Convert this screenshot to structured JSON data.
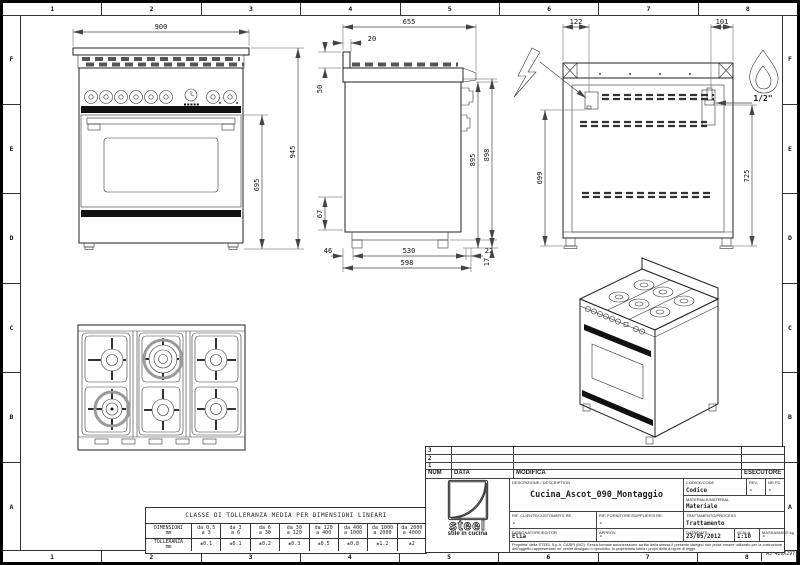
{
  "sheet": {
    "columns": [
      "1",
      "2",
      "3",
      "4",
      "5",
      "6",
      "7",
      "8"
    ],
    "rows": [
      "F",
      "E",
      "D",
      "C",
      "B",
      "A"
    ],
    "format_label": "A3 420X297"
  },
  "drawing": {
    "front": {
      "width": "900",
      "door_height": "695",
      "total_height": "945"
    },
    "side": {
      "total_depth": "655",
      "backsplash_offset": "20",
      "backsplash_height": "50",
      "worktop_height": "895",
      "overall_height": "898",
      "plinth_height": "67",
      "rear_foot_inset": "46",
      "foot_span": "530",
      "front_foot_inset": "22",
      "base_depth": "598",
      "foot_height": "17"
    },
    "back": {
      "electric_offset": "122",
      "gas_offset": "101",
      "electric_height": "699",
      "gas_height": "725",
      "gas_thread": "1/2\""
    }
  },
  "tolerance_table": {
    "title": "CLASSE DI TOLLERANZA MEDIA PER DIMENSIONI LINEARI",
    "dim_header": "DIMENSIONI",
    "dim_unit": "mm",
    "tol_header": "TOLLERANZA",
    "tol_unit": "mm",
    "ranges_from": [
      "da 0.5",
      "da 3",
      "da 6",
      "da 30",
      "da 120",
      "da 400",
      "da 1000",
      "da 2000"
    ],
    "ranges_to": [
      "a 3",
      "a 6",
      "a 30",
      "a 120",
      "a 400",
      "a 1000",
      "a 2000",
      "a 4000"
    ],
    "tolerances": [
      "±0.1",
      "±0.1",
      "±0.2",
      "±0.3",
      "±0.5",
      "±0.8",
      "±1.2",
      "±2"
    ]
  },
  "title_block": {
    "rev_rows": [
      "3",
      "2",
      "1"
    ],
    "num_header": "NUM",
    "data_header": "DATA",
    "modifica_header": "MODIFICA",
    "esecutore_header": "ESECUTORE",
    "description_label": "DESCRIZIONE / DESCRIPTION",
    "description": "Cucina_Ascot_090_Montaggio",
    "code_label": "CODICE/CODE",
    "code": "Codice",
    "rev_label": "REV.",
    "rev": "-",
    "pieces_label": "NR.PZ.",
    "pieces": "-",
    "material_label": "MATERIALE/MATERIAL",
    "material": "Materiale",
    "customer_label": "RIF. CLIENTE/CUSTOMER'S RE.",
    "customer": "-",
    "supplier_label": "RIF. FORNITORE/SUPPLIER'S RE.",
    "supplier": "-",
    "treatment_label": "TRATTAMENTO/PROCESS",
    "treatment": "Trattamento",
    "editor_label": "DISEGNATORE/EDITOR",
    "editor": "Elia",
    "approval_label": "APPROV.",
    "approval": "-",
    "date_label": "DATA/DATE",
    "date": "23/05/2012",
    "scale_label": "SCALA",
    "scale": "1:10",
    "mass_label": "MASSA/MASS kg",
    "mass": "-",
    "logo_text": "steel",
    "logo_subtext": "stile in cucina",
    "legal": "Proprieta' della STEEL S.p.A. CARPI (MO). Senza formale autorizzazione scritta della stessa il presente disegno non potra' essere utilizzato per la costruzione dell'oggetto rappresentato ne' venire divulgato o riprodotto, la proprietaria tutela i propri diritti a rigore di legge."
  }
}
